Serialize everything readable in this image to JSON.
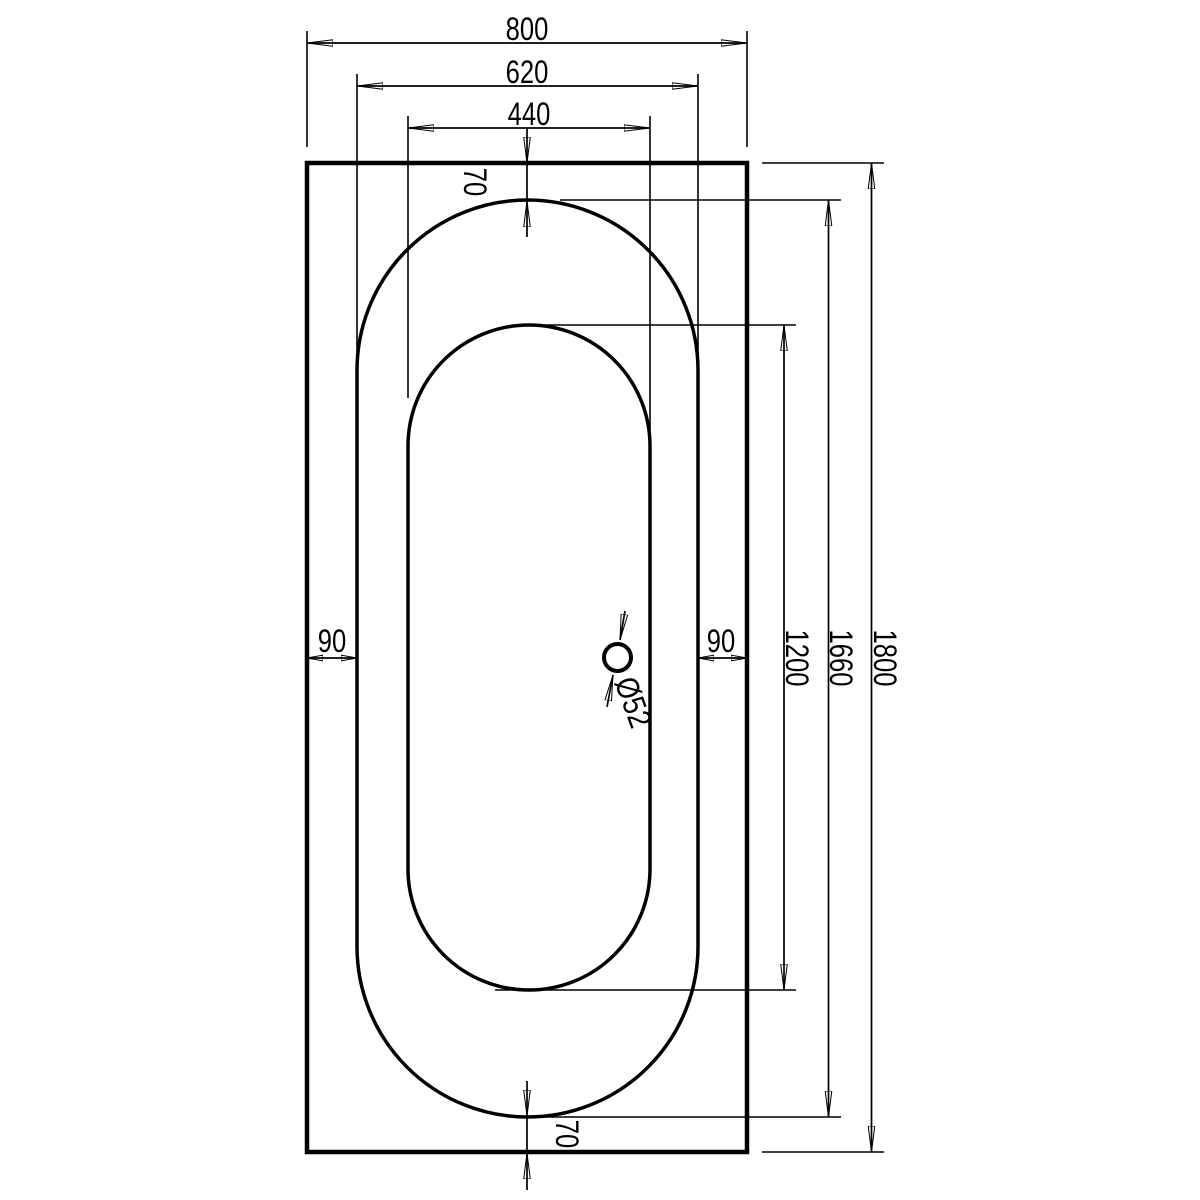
{
  "drawing": {
    "title": "Bathtub top view dimensional drawing",
    "background_color": "#ffffff",
    "line_color": "#000000",
    "dimensions": {
      "width_overall": "800",
      "width_rim": "620",
      "width_basin": "440",
      "rim_gap_top": "70",
      "rim_gap_bottom": "70",
      "rim_gap_left": "90",
      "rim_gap_right": "90",
      "length_basin": "1200",
      "length_rim": "1660",
      "length_overall": "1800",
      "drain_diameter": "Ø52"
    }
  }
}
